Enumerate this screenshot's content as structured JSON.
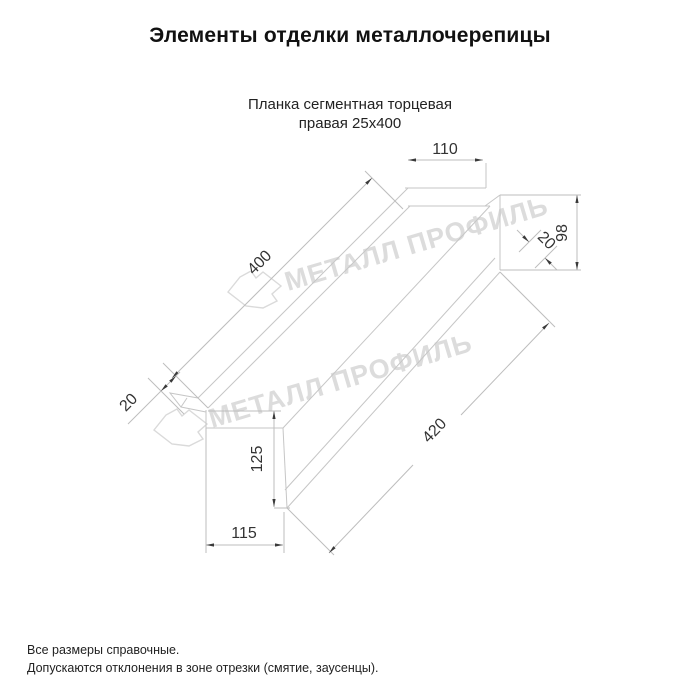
{
  "title": "Элементы отделки металлочерепицы",
  "subtitle": {
    "line1": "Планка сегментная торцевая",
    "line2": "правая 25х400"
  },
  "watermark": {
    "text": "МЕТАЛЛ ПРОФИЛЬ",
    "color": "#dcdcdc"
  },
  "drawing": {
    "part": "Планка сегментная торцевая правая 25х400",
    "dims": {
      "top_width": "110",
      "right_height": "98",
      "right_fold": "20",
      "top_length": "400",
      "left_fold": "20",
      "bottom_length": "420",
      "left_height": "125",
      "bottom_width": "115"
    },
    "line_color": "#c6c6c6",
    "dim_color": "#333333"
  },
  "footer": {
    "line1": "Все размеры справочные.",
    "line2": "Допускаются отклонения в зоне отрезки (смятие, заусенцы)."
  }
}
